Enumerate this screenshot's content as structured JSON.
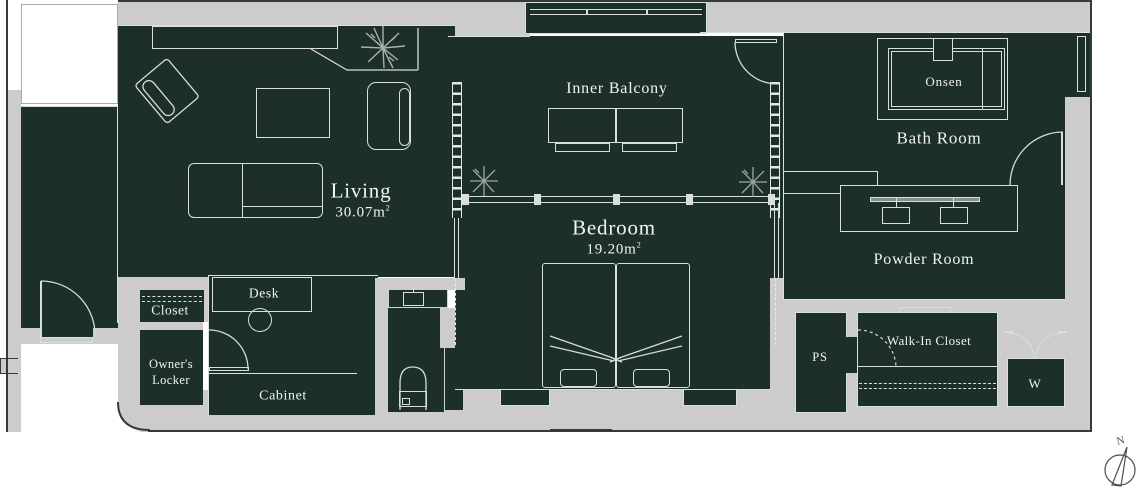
{
  "rooms": {
    "living": {
      "name": "Living",
      "area": "30.07",
      "unit": "m",
      "unit_exp": "2"
    },
    "inner_balcony": {
      "name": "Inner Balcony"
    },
    "bedroom": {
      "name": "Bedroom",
      "area": "19.20",
      "unit": "m",
      "unit_exp": "2"
    },
    "bath": {
      "name": "Bath Room"
    },
    "powder": {
      "name": "Powder Room"
    },
    "closet": {
      "name": "Closet"
    },
    "owners_locker": {
      "name_line1": "Owner's",
      "name_line2": "Locker"
    },
    "cabinet": {
      "name": "Cabinet"
    },
    "ps": {
      "name": "PS"
    },
    "walk_in_closet": {
      "name": "Walk-In Closet"
    },
    "laundry": {
      "name": "W"
    }
  },
  "fixtures": {
    "onsen": "Onsen",
    "desk": "Desk"
  },
  "compass": {
    "north": "N"
  },
  "colors": {
    "floor": "#1c2f28",
    "wall": "#cbcccb",
    "outline": "#343b36",
    "linework": "#d9e0da",
    "text": "#f1f4f0",
    "paper": "#ffffff"
  }
}
